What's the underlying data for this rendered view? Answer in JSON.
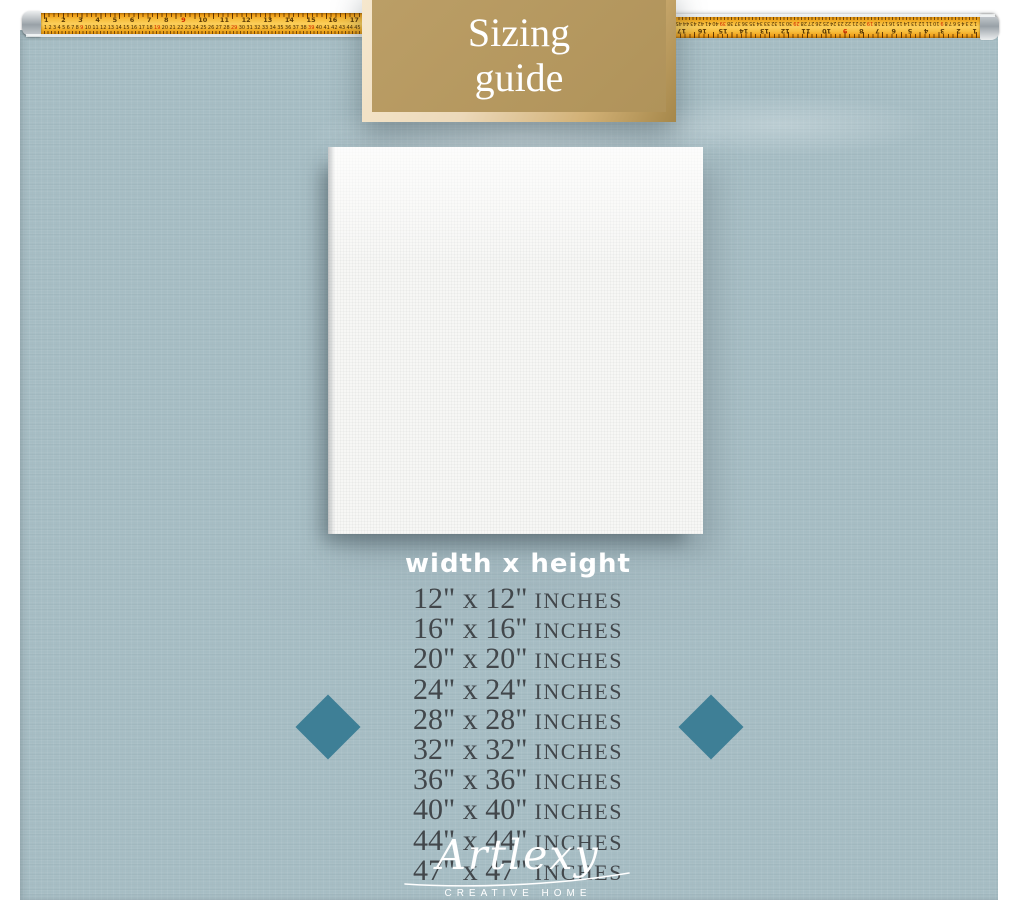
{
  "header": {
    "line1": "Sizing",
    "line2": "guide"
  },
  "tape": {
    "inch_numbers": [
      "1",
      "2",
      "3",
      "4",
      "5",
      "6",
      "7",
      "8",
      "9",
      "10",
      "11",
      "12",
      "13",
      "14",
      "15",
      "16",
      "17"
    ],
    "cm_numbers": [
      "1",
      "2",
      "3",
      "4",
      "5",
      "6",
      "7",
      "8",
      "9",
      "10",
      "11",
      "12",
      "13",
      "14",
      "15",
      "16",
      "17",
      "18",
      "19",
      "20",
      "21",
      "22",
      "23",
      "24",
      "25",
      "26",
      "27",
      "28",
      "29",
      "30",
      "31",
      "32",
      "33",
      "34",
      "35",
      "36",
      "37",
      "38",
      "39",
      "40",
      "41",
      "42",
      "43",
      "44",
      "45"
    ]
  },
  "sizing": {
    "column_header": "width x height",
    "rows": [
      {
        "size": "12\" x 12\"",
        "unit": "INCHES"
      },
      {
        "size": "16\" x 16\"",
        "unit": "INCHES"
      },
      {
        "size": "20\" x 20\"",
        "unit": "INCHES"
      },
      {
        "size": "24\" x 24\"",
        "unit": "INCHES"
      },
      {
        "size": "28\" x 28\"",
        "unit": "INCHES"
      },
      {
        "size": "32\" x 32\"",
        "unit": "INCHES"
      },
      {
        "size": "36\" x 36\"",
        "unit": "INCHES"
      },
      {
        "size": "40\" x 40\"",
        "unit": "INCHES"
      },
      {
        "size": "44\" x 44\"",
        "unit": "INCHES"
      },
      {
        "size": "47\" x 47\"",
        "unit": "INCHES"
      }
    ]
  },
  "brand": {
    "name": "Artlexy",
    "tagline": "CREATIVE HOME"
  },
  "colors": {
    "panel": "#a6bdc4",
    "header_box": "#b0935a",
    "header_border": "#ecd9ba",
    "diamond": "#3e7f96",
    "tape_yellow": "#f5b93a",
    "size_text": "#42474b",
    "canvas": "#f7f7f5",
    "text_light": "#ffffff"
  }
}
